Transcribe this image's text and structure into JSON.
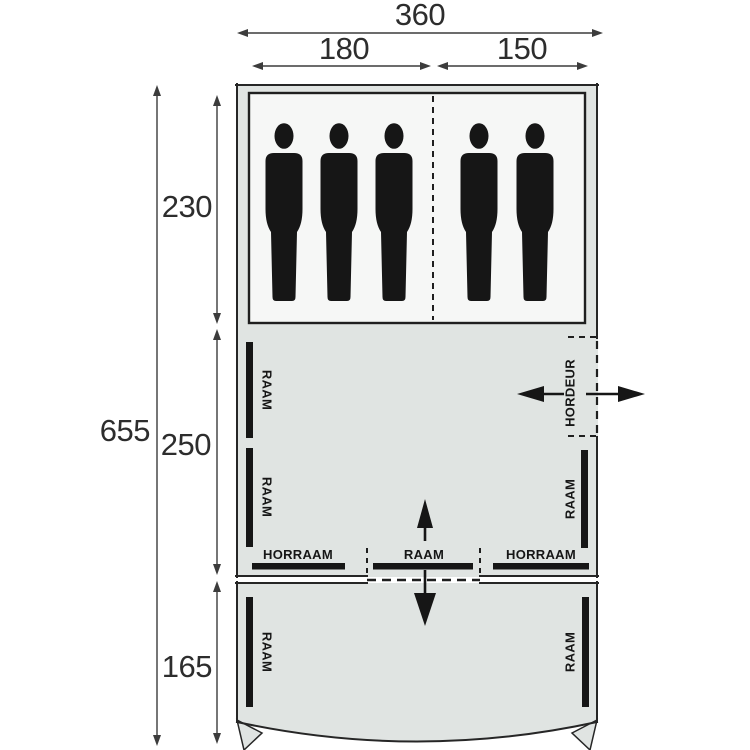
{
  "diagram": {
    "kind": "tent-floorplan",
    "sections": [
      "sleeping-cabins",
      "living-area",
      "front-canopy"
    ]
  },
  "dimensions": {
    "width_total": "360",
    "width_left_cabin": "180",
    "width_right_cabin": "150",
    "length_total": "655",
    "depth_sleeping": "230",
    "depth_living": "250",
    "depth_front": "165"
  },
  "features": {
    "window_label": "RAAM",
    "mesh_window_label": "HORRAAM",
    "mesh_door_label": "HORDEUR"
  },
  "people": {
    "left_cabin_count": 3,
    "right_cabin_count": 2,
    "total": 5
  },
  "icons": [
    "person-icon",
    "entrance-arrow-in-icon",
    "entrance-arrow-out-icon",
    "front-door-up-arrow-icon",
    "front-door-down-arrow-icon",
    "dimension-arrow-icon"
  ],
  "colors": {
    "canvas_fill": "#e0e4e2",
    "cabin_fill": "#f6f7f6",
    "line": "#262626",
    "ink": "#161616",
    "dim_line": "#3c3c3c"
  }
}
